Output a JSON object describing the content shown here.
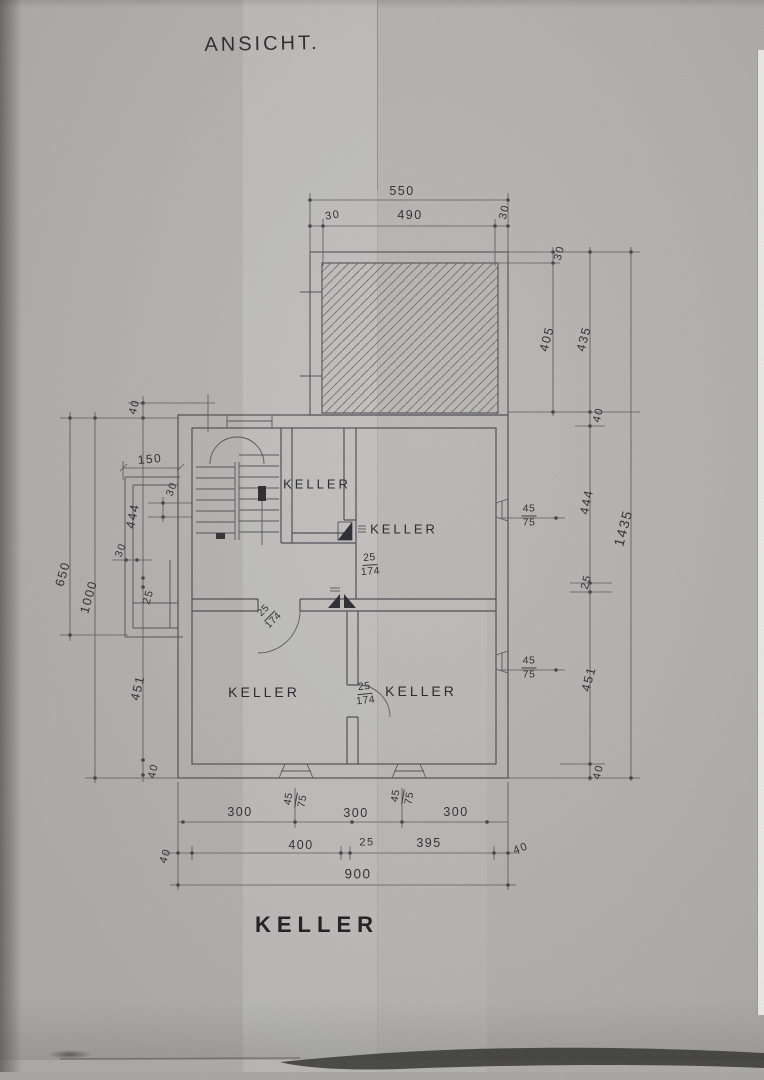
{
  "titles": {
    "top": "ANSICHT.",
    "bottom": "KELLER"
  },
  "rooms": {
    "top_center": "KELLER",
    "upper_right": "KELLER",
    "lower_left": "KELLER",
    "lower_right": "KELLER"
  },
  "dims": {
    "top": {
      "overall": "550",
      "left_wall": "30",
      "opening": "490",
      "right_wall": "30"
    },
    "right": {
      "wall_30": "30",
      "d405": "405",
      "d435": "435",
      "d40_top": "40",
      "d444": "444",
      "d25": "25",
      "d451": "451",
      "d40_bottom": "40",
      "overall": "1435"
    },
    "left": {
      "d40_top": "40",
      "d150": "150",
      "d30_upper": "30",
      "d30_lower": "30",
      "d444": "444",
      "d650": "650",
      "d1000": "1000",
      "d25": "25",
      "d451": "451",
      "d40_bottom": "40"
    },
    "bottom": {
      "seg300_left": "300",
      "seg300_mid": "300",
      "seg300_right": "300",
      "d40_left": "40",
      "d400": "400",
      "d25": "25",
      "d395": "395",
      "d40_right": "40",
      "overall": "900"
    }
  },
  "specs": {
    "window": {
      "num": "45",
      "den": "75"
    },
    "door": {
      "num": "25",
      "den": "174"
    }
  }
}
